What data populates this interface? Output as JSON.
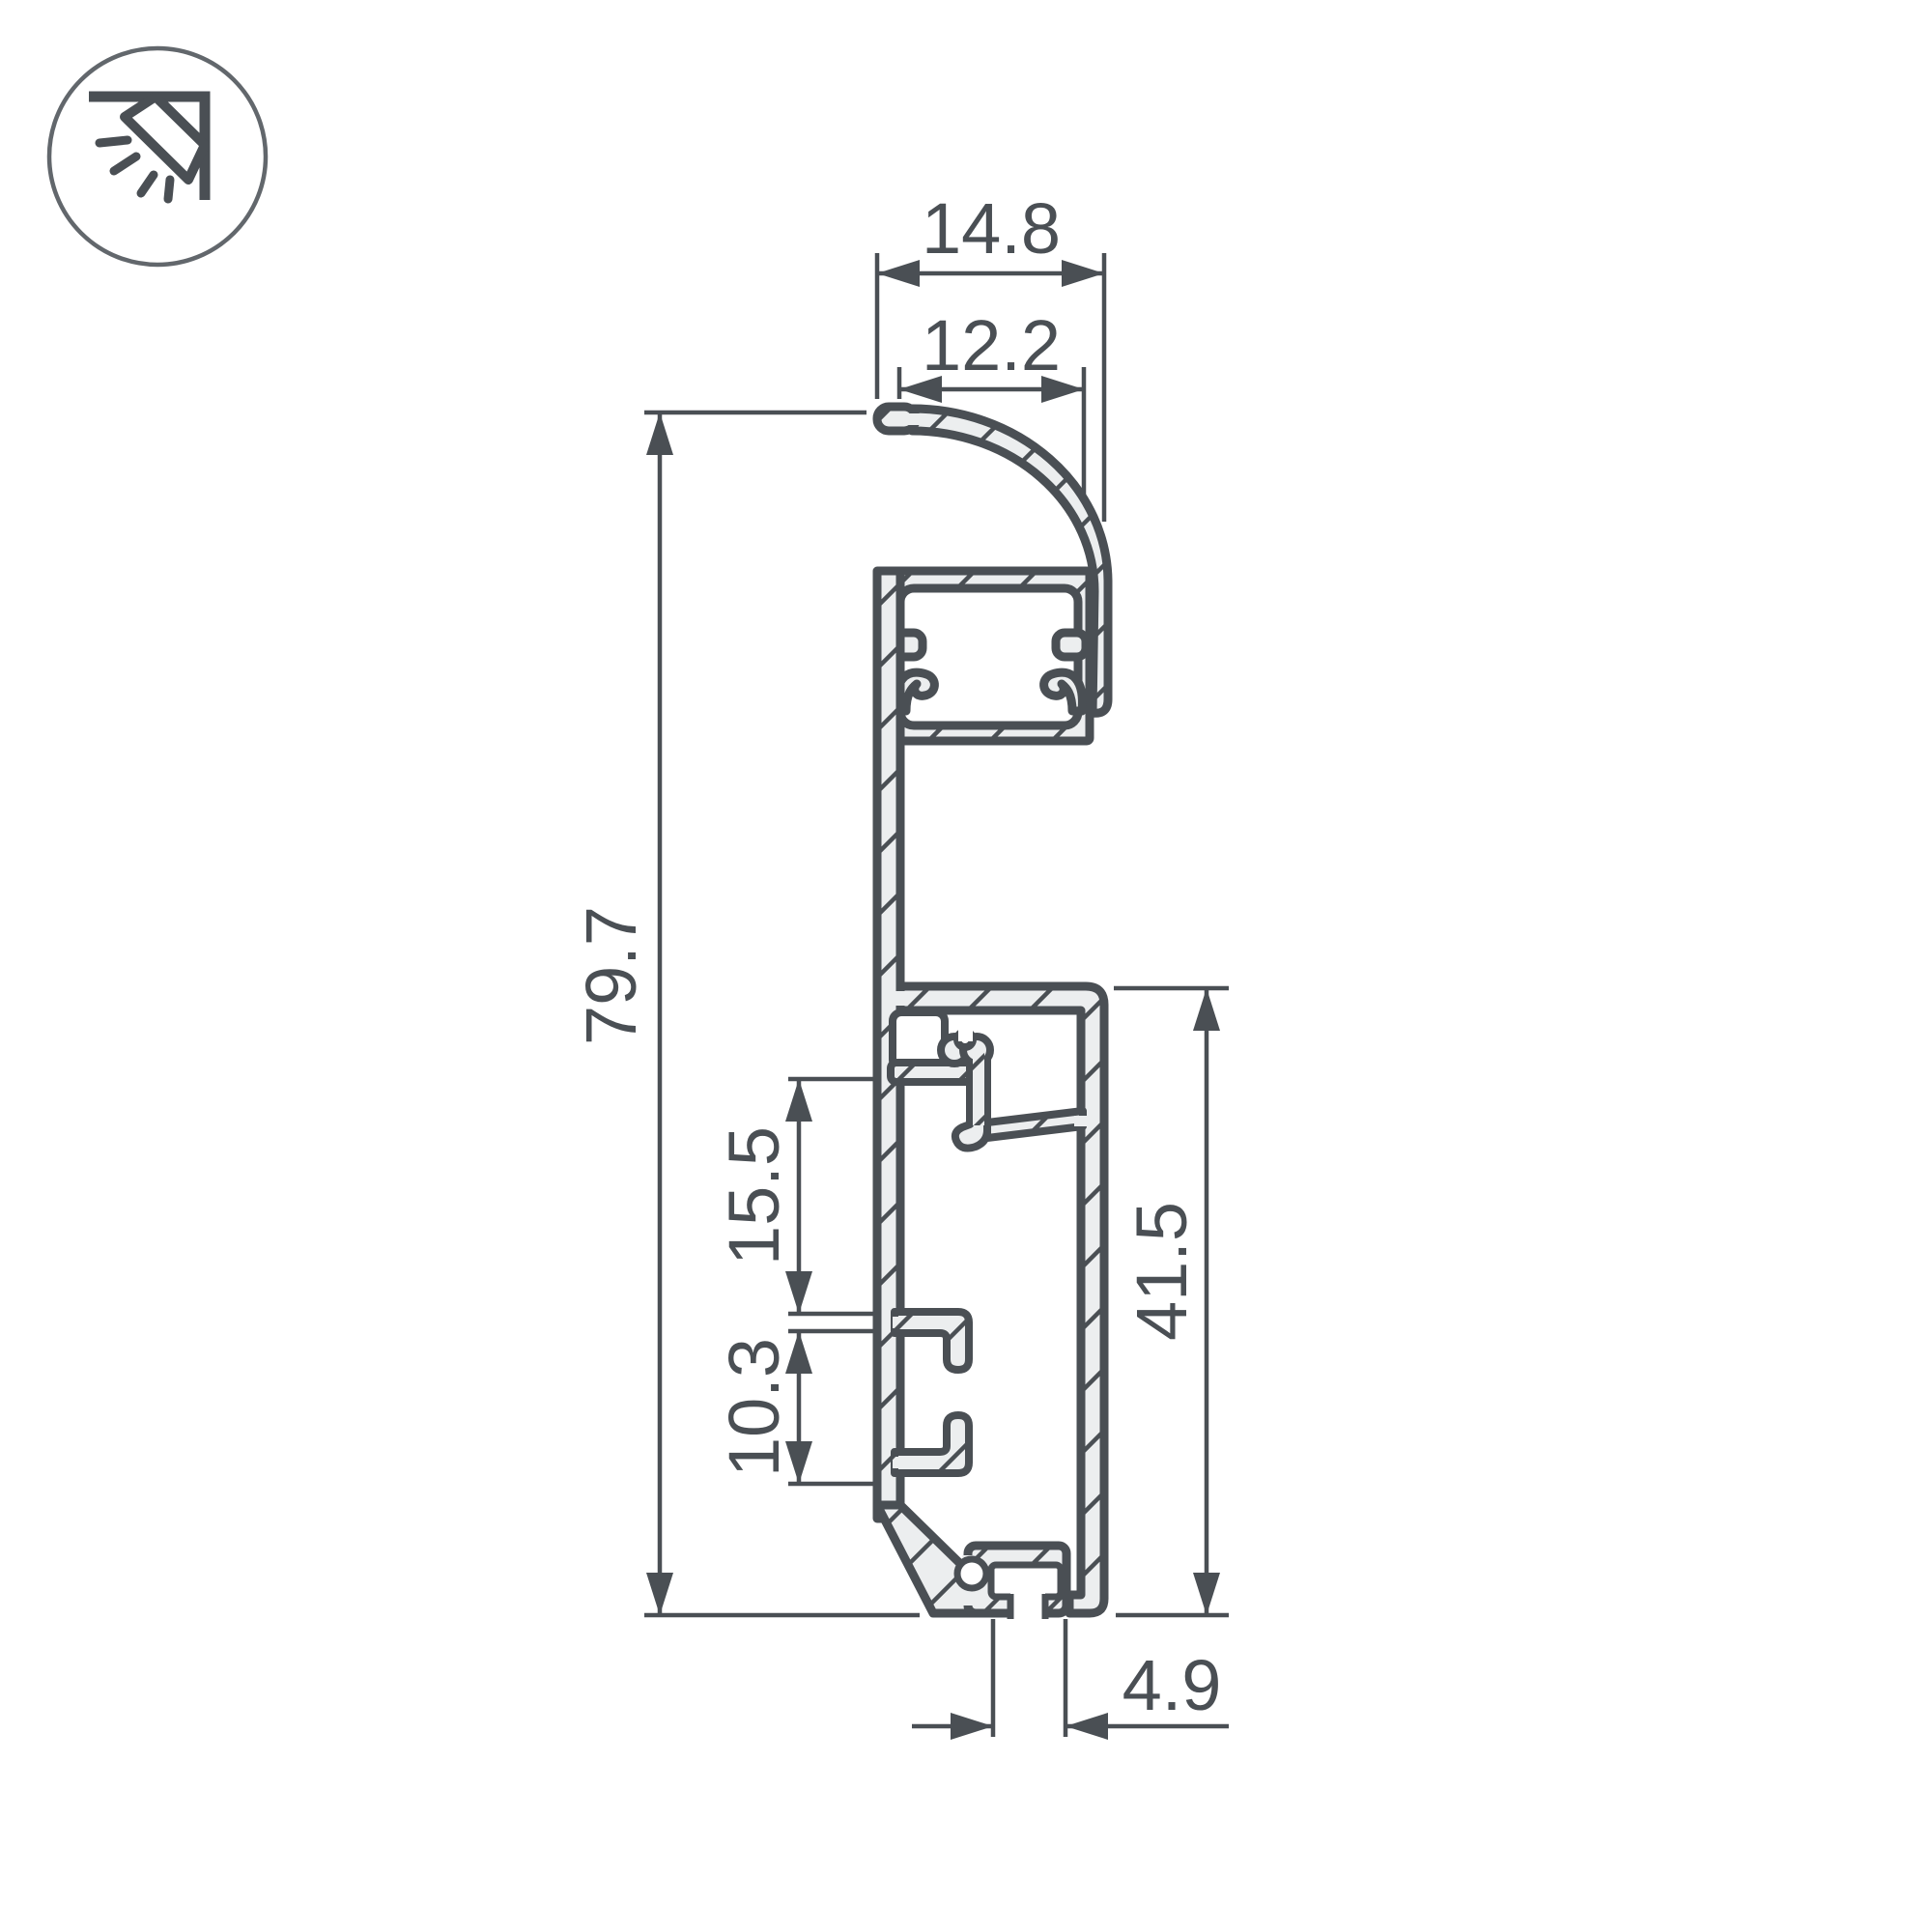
{
  "drawing": {
    "kind": "profile-cross-section-technical-drawing",
    "colors": {
      "line": "#4a4f54",
      "aluminum_fill": "#eceeef",
      "background": "#ffffff"
    },
    "icon": {
      "name": "wall-grazing-light-icon"
    },
    "dimensions": {
      "top_width": "14.8",
      "visor_width": "12.2",
      "total_height": "79.7",
      "clip_gap": "15.5",
      "hook_gap": "10.3",
      "base_height": "41.5",
      "slot_width": "4.9"
    }
  }
}
